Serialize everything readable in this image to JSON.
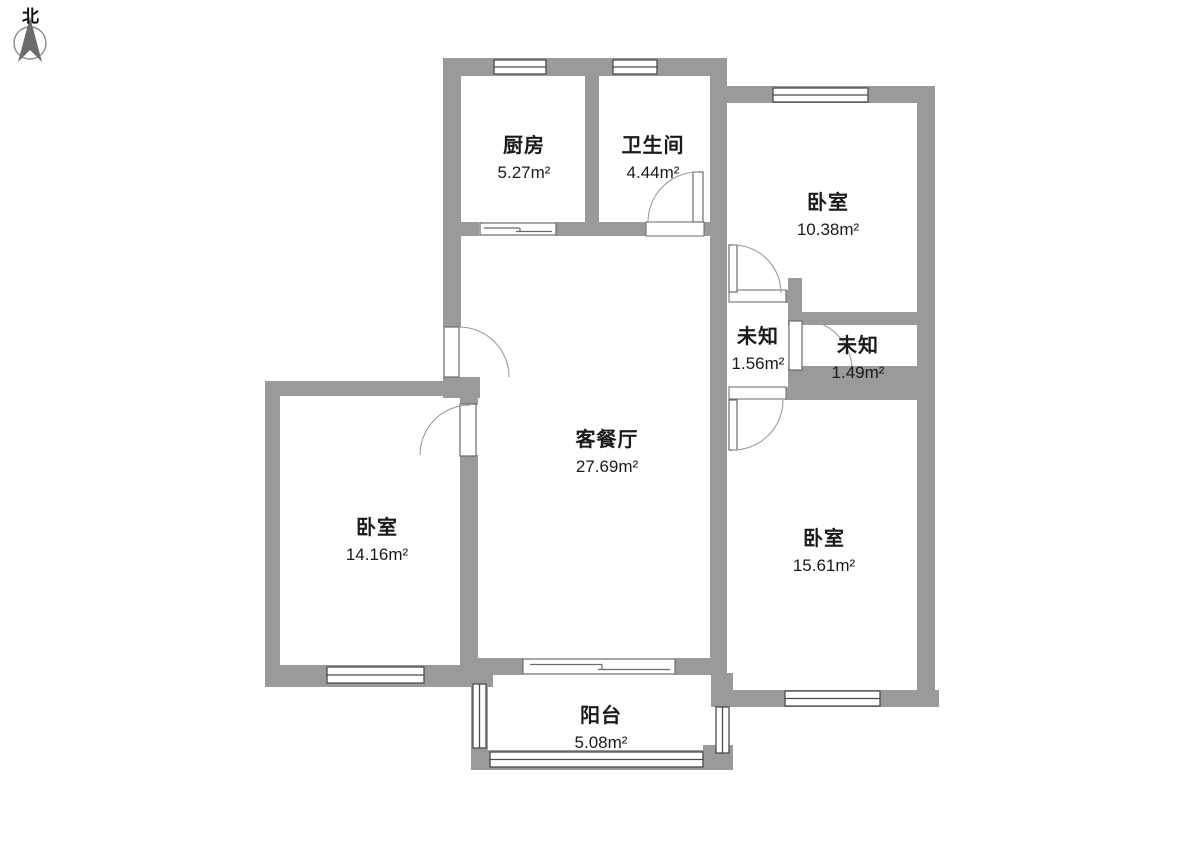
{
  "compass": {
    "label": "北"
  },
  "colors": {
    "wall": "#9a9a9a",
    "wall_dark": "#8f8f8f",
    "frame_line": "#4b4b4b",
    "arc_line": "#9b9b9b",
    "text": "#1a1a1a",
    "bg": "#ffffff",
    "compass_needle": "#6b6b6b",
    "compass_ring": "#8a8a8a"
  },
  "rooms": [
    {
      "id": "kitchen",
      "name": "厨房",
      "area": "5.27m²"
    },
    {
      "id": "bathroom",
      "name": "卫生间",
      "area": "4.44m²"
    },
    {
      "id": "bedroom-top-right",
      "name": "卧室",
      "area": "10.38m²"
    },
    {
      "id": "unknown-left",
      "name": "未知",
      "area": "1.56m²"
    },
    {
      "id": "unknown-right",
      "name": "未知",
      "area": "1.49m²"
    },
    {
      "id": "living-dining",
      "name": "客餐厅",
      "area": "27.69m²"
    },
    {
      "id": "bedroom-left",
      "name": "卧室",
      "area": "14.16m²"
    },
    {
      "id": "bedroom-bottom-right",
      "name": "卧室",
      "area": "15.61m²"
    },
    {
      "id": "balcony",
      "name": "阳台",
      "area": "5.08m²"
    }
  ]
}
